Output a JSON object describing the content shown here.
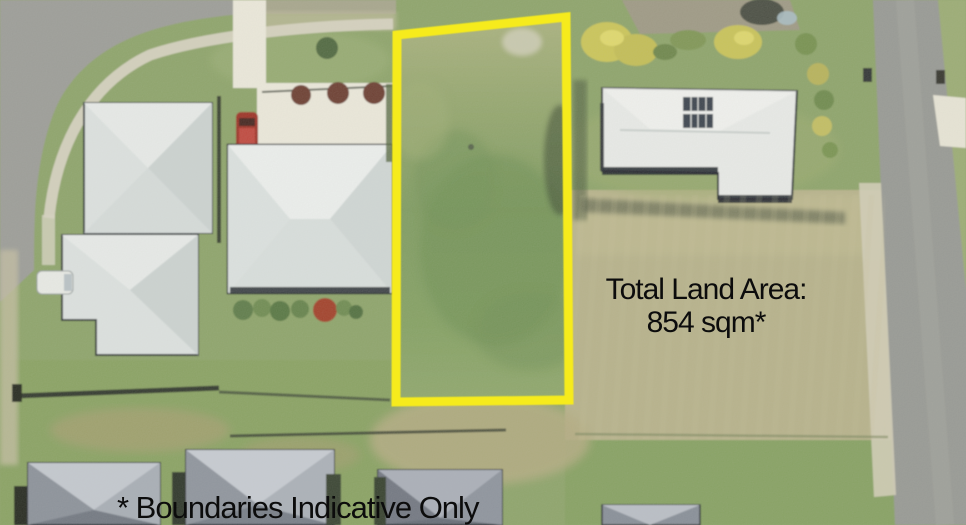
{
  "annotations": {
    "land_area": {
      "line1": "Total Land Area:",
      "line2": "854 sqm*"
    },
    "disclaimer": "* Boundaries Indicative Only"
  },
  "lot": {
    "boundary_color": "#f6eb1e",
    "area_value": "854 sqm"
  },
  "colors": {
    "annotation_text": "#0c0c0c",
    "road": "#96989(3",
    "lot_grass": "#7d9a5e"
  }
}
